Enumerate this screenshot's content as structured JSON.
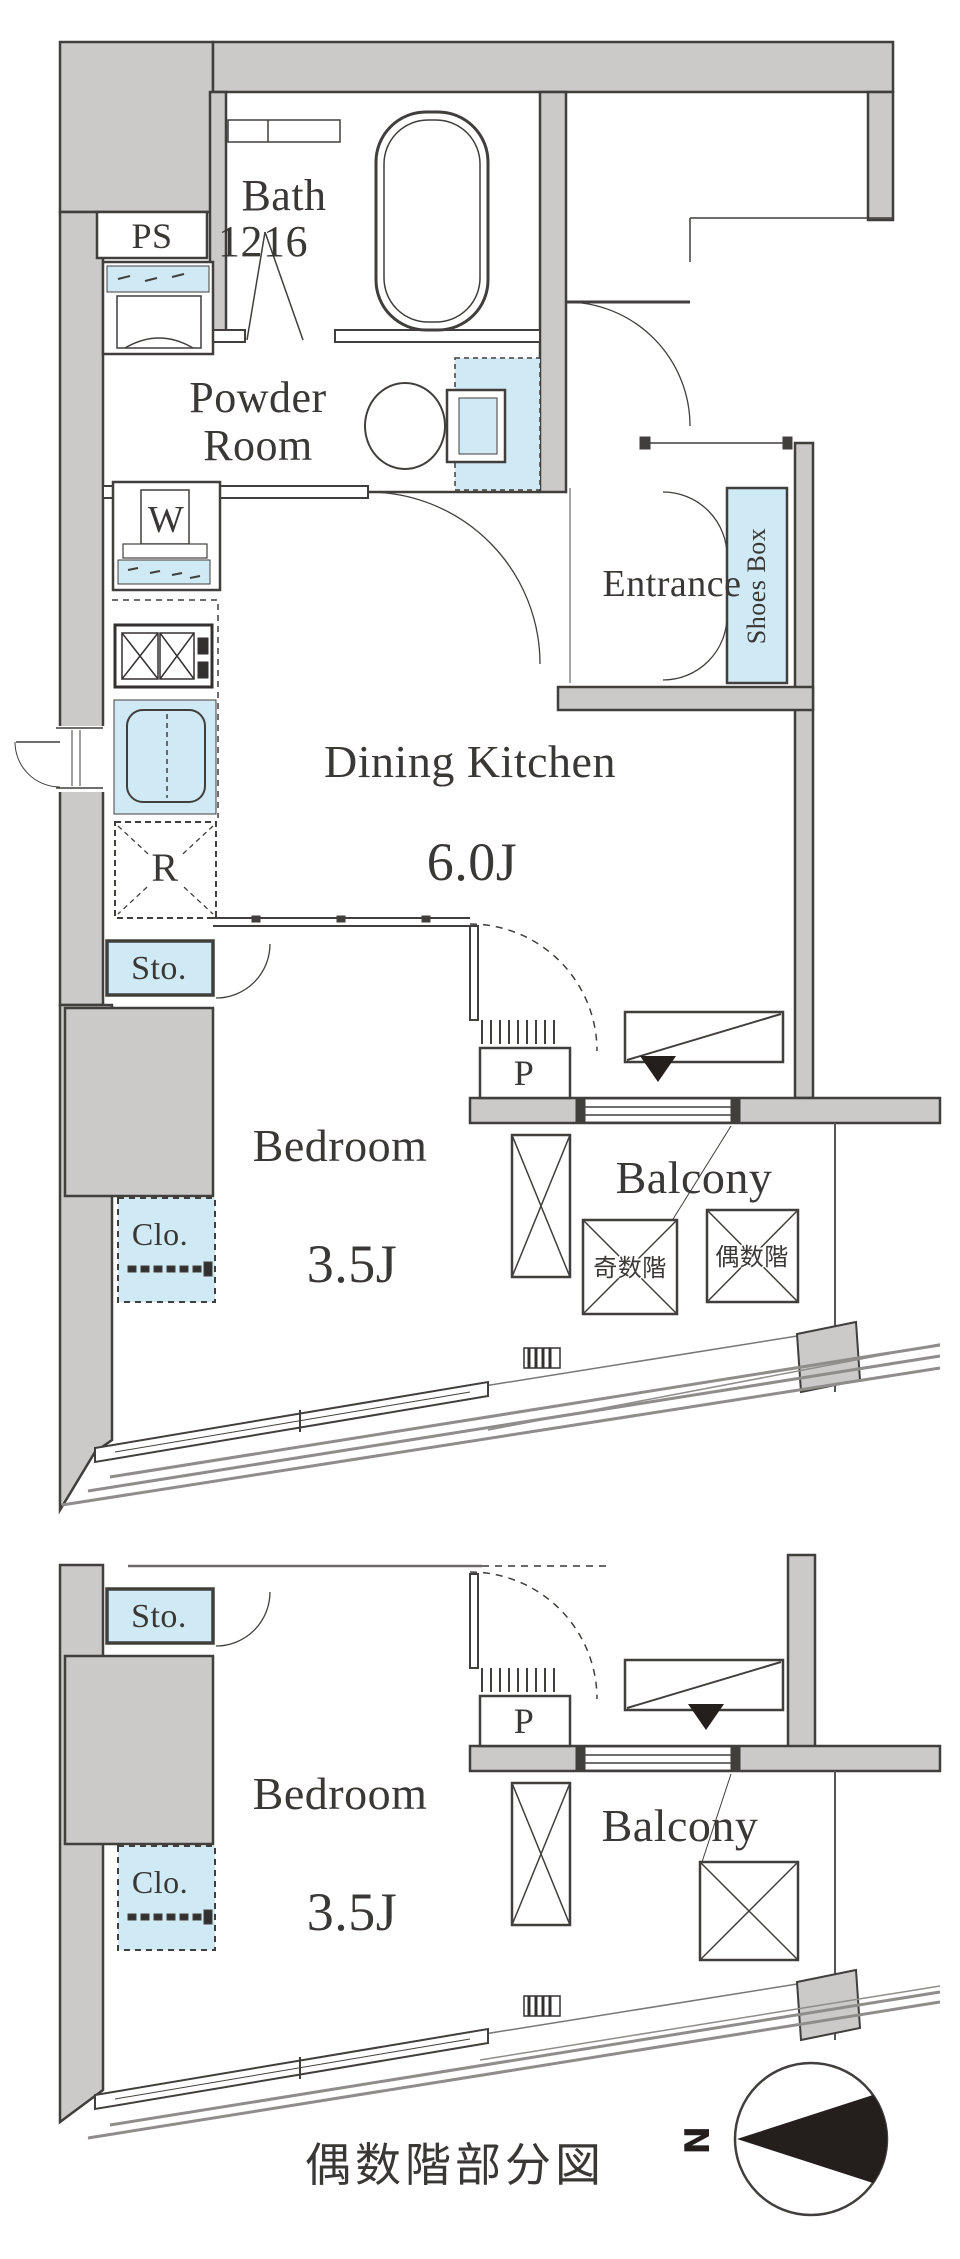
{
  "colors": {
    "wall_fill": "#cbcac8",
    "line_dark": "#413f3c",
    "accent_blue": "#cfe9f5",
    "railing_gray": "#8f8d8a",
    "text": "#3a3835"
  },
  "upper": {
    "bath_label": "Bath",
    "bath_size": "1216",
    "ps_label": "PS",
    "powder_line1": "Powder",
    "powder_line2": "Room",
    "washer_label": "W",
    "entrance_label": "Entrance",
    "shoes_box_label": "Shoes Box",
    "dk_label": "Dining Kitchen",
    "dk_size": "6.0J",
    "fridge_label": "R",
    "storage_label": "Sto.",
    "bedroom_label": "Bedroom",
    "bedroom_size": "3.5J",
    "closet_label": "Clo.",
    "pipe_label": "P",
    "balcony_label": "Balcony",
    "hatch_odd_label": "奇数階",
    "hatch_even_label": "偶数階"
  },
  "lower": {
    "storage_label": "Sto.",
    "closet_label": "Clo.",
    "bedroom_label": "Bedroom",
    "bedroom_size": "3.5J",
    "pipe_label": "P",
    "balcony_label": "Balcony"
  },
  "caption": "偶数階部分図",
  "compass_label": "N"
}
